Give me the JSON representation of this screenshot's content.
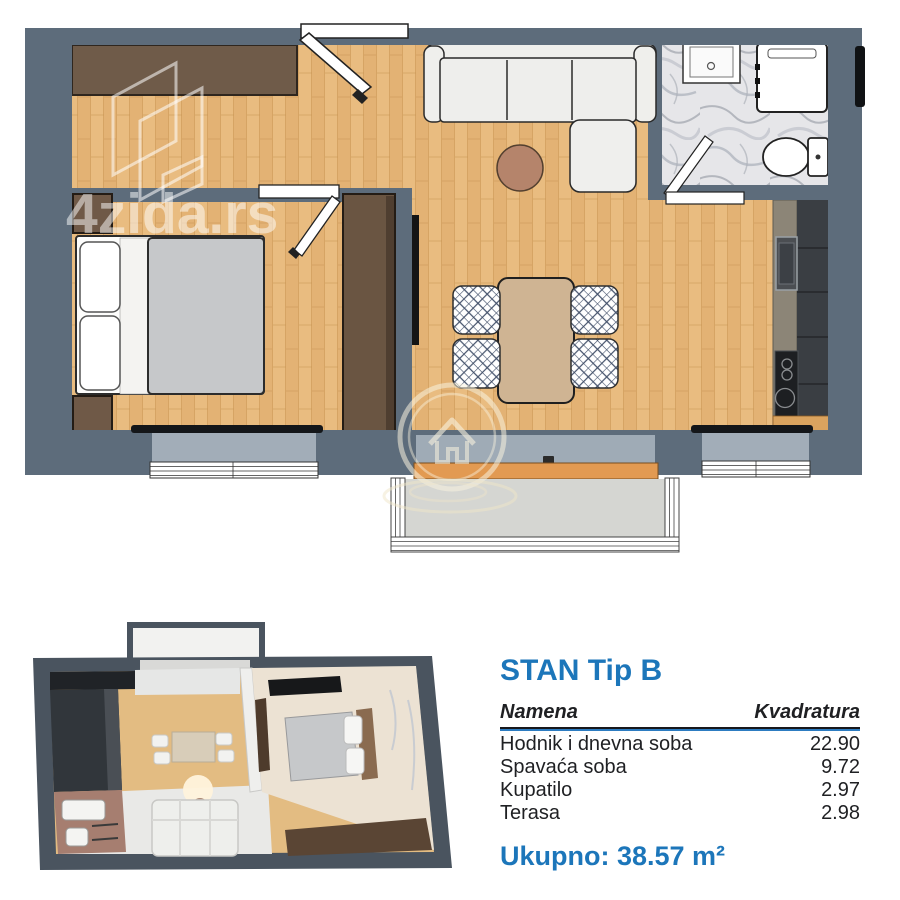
{
  "watermark": {
    "brand": "4zida.rs"
  },
  "panel": {
    "title": "STAN Tip B",
    "table": {
      "headers": {
        "name": "Namena",
        "area": "Kvadratura"
      },
      "rows": [
        {
          "name": "Hodnik i dnevna soba",
          "area": "22.90"
        },
        {
          "name": "Spavaća soba",
          "area": "9.72"
        },
        {
          "name": "Kupatilo",
          "area": "2.97"
        },
        {
          "name": "Terasa",
          "area": "2.98"
        }
      ],
      "total": "Ukupno: 38.57 m²"
    }
  },
  "colors": {
    "accent_blue": "#1c76ba",
    "underline_blue": "#2d7cc1",
    "wall": "#5d6c7b",
    "wood_floor": "#e9bc80",
    "wardrobe_brown": "#6f5b49",
    "terrace_floor": "#d5d6d2",
    "threshold_orange": "#e29a52",
    "text": "#1f2023"
  }
}
